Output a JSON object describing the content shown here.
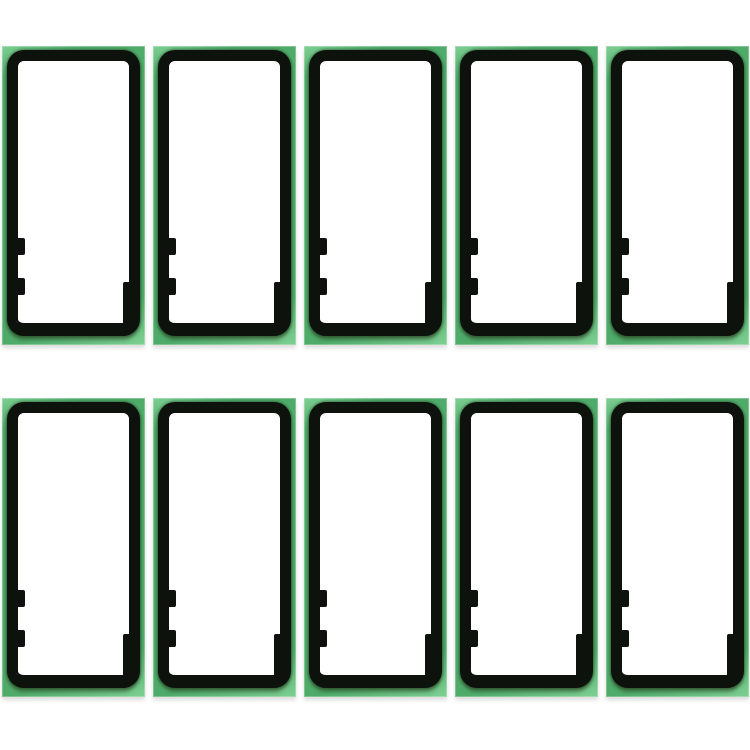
{
  "product": {
    "description": "Ten green rear-housing frame adhesive sticker sheets on a white background",
    "item_name": "frame-adhesive-sticker-sheet",
    "count": 10
  },
  "grid": {
    "rows": 2,
    "columns": 5
  },
  "sticker_features": {
    "left_alignment_tabs": 2,
    "right_edge_steps": 1,
    "interior": "empty white cut-out",
    "frame_shape": "rounded rectangle outline"
  },
  "colors": {
    "background": "#ffffff",
    "sheet_green": "#4fab69",
    "sheet_green_highlight": "#7ed092",
    "frame_black": "#0d120d",
    "frame_olive_shadow": "rgba(45, 76, 43, 0.55)",
    "interior_white": "#ffffff"
  }
}
